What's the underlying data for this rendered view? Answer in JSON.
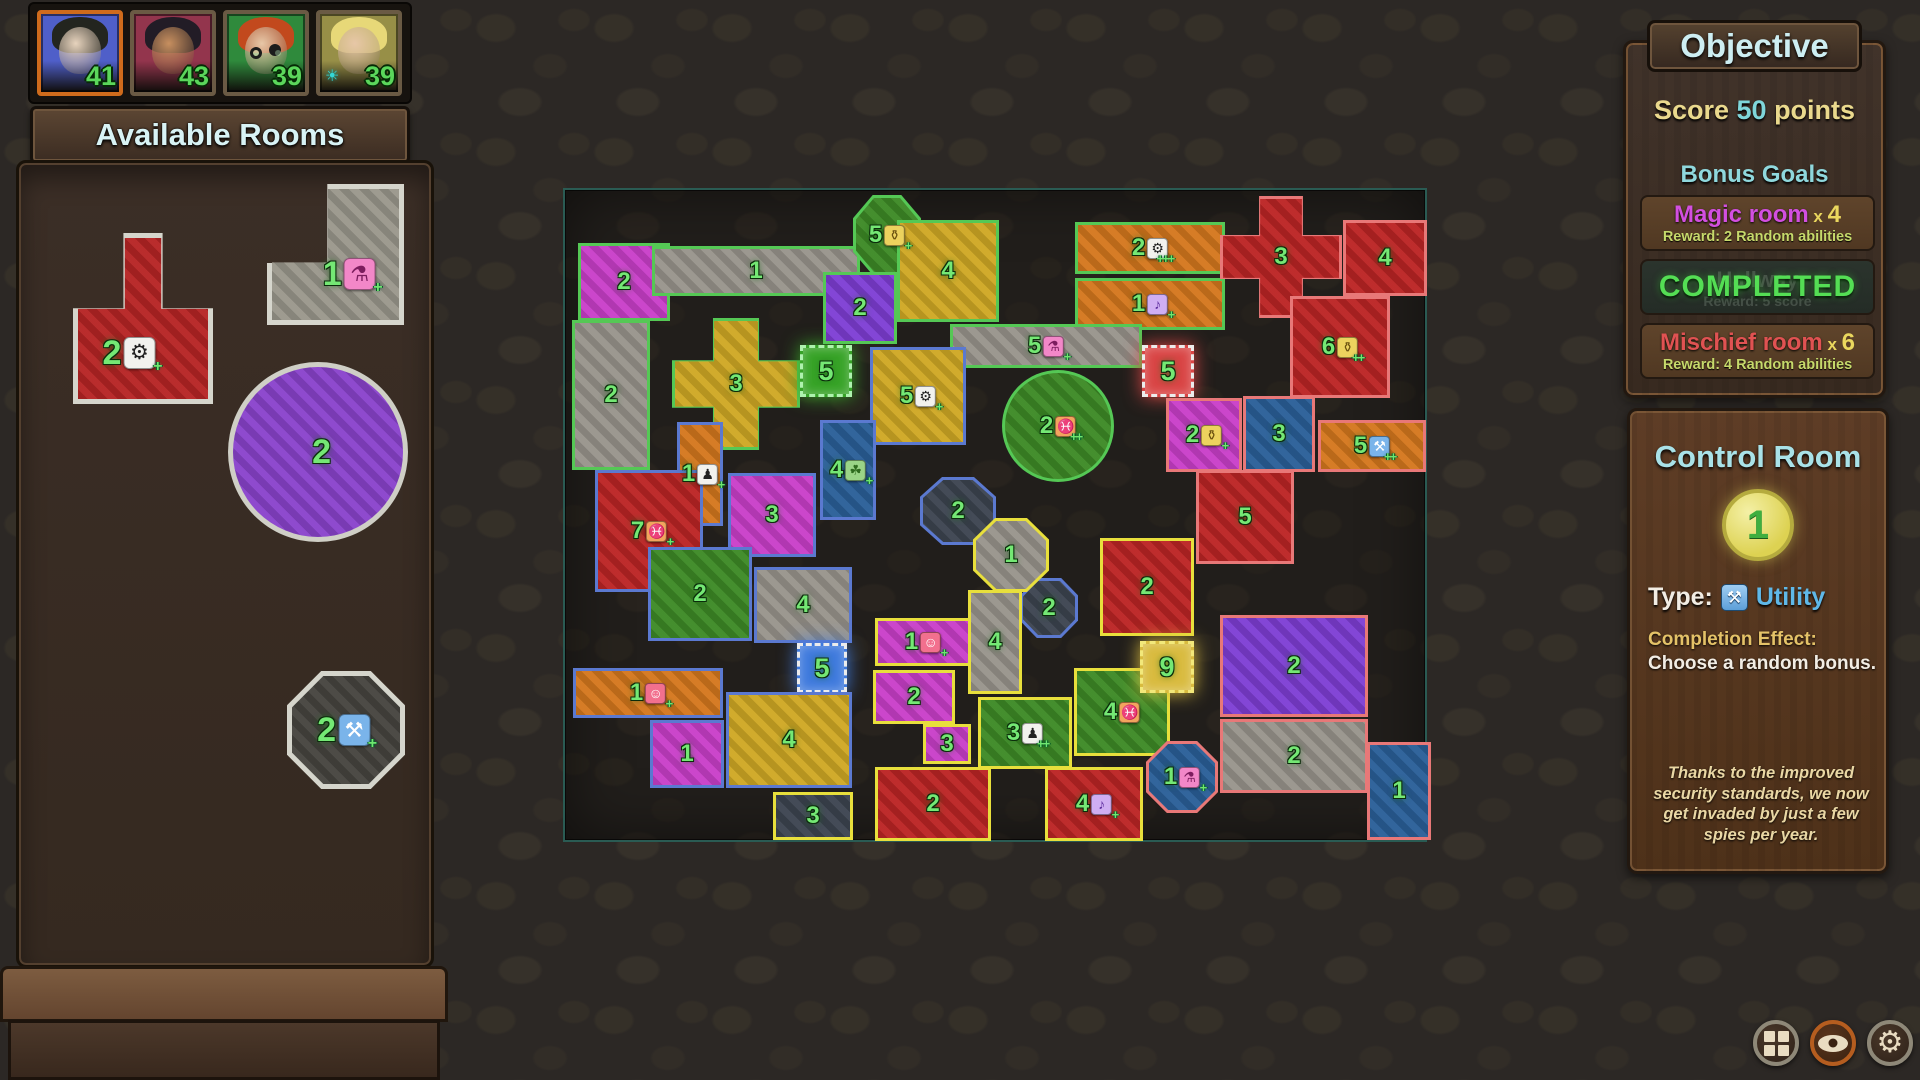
{
  "palette": {
    "fills": {
      "gray": "#98948c",
      "mag": "#c93fc9",
      "yel": "#cfa824",
      "org": "#d4771d",
      "red": "#bb2424",
      "pur": "#7e3ed4",
      "grn": "#3d8a26",
      "blu": "#2a5f98",
      "sla": "#3c4450",
      "gred": "#d94545",
      "gblu": "#3f7add",
      "ggld": "#d9bb3f",
      "ggrn": "#37a327"
    },
    "borders": {
      "g": "#55c855",
      "b": "#5b79d0",
      "y": "#e8df3c",
      "p": "#e87878",
      "w": "#ececec",
      "lg": "#d5d5cc",
      "ly": "#f2e87a",
      "lgn": "#aef2ae"
    },
    "accent_active_player": "#cf6b1c",
    "score_color": "#5bd65b",
    "map_frame": "#2a5b53"
  },
  "players": [
    {
      "score": "41",
      "bg": "#4f5fc9",
      "hair": "#23251f",
      "skin": "#e7d3bd",
      "active": true
    },
    {
      "score": "43",
      "bg": "#93354d",
      "hair": "#221c26",
      "skin": "#c78f5f"
    },
    {
      "score": "39",
      "bg": "#2f8a3c",
      "hair": "#c2491d",
      "skin": "#e7c7a7",
      "glasses": true
    },
    {
      "score": "39",
      "bg": "#978f47",
      "hair": "#e7d878",
      "skin": "#e7c7a7",
      "sun_badge": true
    }
  ],
  "left_panel": {
    "title": "Available Rooms",
    "tiles": [
      {
        "n": "2",
        "fill": "#b62424",
        "border": "#d5d5cc",
        "shape": "tee",
        "badge": {
          "i": "gear",
          "p": "+"
        },
        "x": 73,
        "y": 233,
        "w": 140,
        "h": 171,
        "cx": 40,
        "cy": 70
      },
      {
        "n": "1",
        "fill": "#9a978c",
        "border": "#d5d5cc",
        "shape": "ell",
        "badge": {
          "i": "potion",
          "p": "+"
        },
        "x": 267,
        "y": 184,
        "w": 137,
        "h": 141,
        "cx": 60,
        "cy": 64
      },
      {
        "n": "2",
        "fill": "#8a43cc",
        "border": "#cfcfc6",
        "shape": "circle",
        "x": 228,
        "y": 362,
        "w": 180,
        "h": 180,
        "cx": 52,
        "cy": 50
      },
      {
        "n": "2",
        "fill": "#46443f",
        "border": "#d5d5cc",
        "shape": "oct",
        "badge": {
          "i": "wrench",
          "p": "+"
        },
        "x": 287,
        "y": 671,
        "w": 118,
        "h": 118,
        "cx": 48,
        "cy": 50
      }
    ]
  },
  "map": {
    "frame": {
      "x": 563,
      "y": 188,
      "w": 864,
      "h": 654
    },
    "rooms": [
      {
        "n": "2",
        "x": 578,
        "y": 243,
        "w": 92,
        "h": 78,
        "f": "mag",
        "b": "g"
      },
      {
        "n": "1",
        "x": 652,
        "y": 246,
        "w": 208,
        "h": 50,
        "f": "gray",
        "b": "g"
      },
      {
        "n": "2",
        "x": 572,
        "y": 320,
        "w": 78,
        "h": 150,
        "f": "gray",
        "b": "g"
      },
      {
        "n": "3",
        "x": 672,
        "y": 318,
        "w": 128,
        "h": 132,
        "f": "yel",
        "b": "g",
        "s": "cross"
      },
      {
        "n": "5",
        "x": 800,
        "y": 345,
        "w": 52,
        "h": 52,
        "f": "ggrn",
        "b": "lgn",
        "g": true
      },
      {
        "n": "5",
        "x": 853,
        "y": 195,
        "w": 68,
        "h": 80,
        "f": "grn",
        "b": "g",
        "s": "oct",
        "bd": {
          "i": "bag",
          "p": "+"
        }
      },
      {
        "n": "2",
        "x": 823,
        "y": 272,
        "w": 74,
        "h": 72,
        "f": "pur",
        "b": "g"
      },
      {
        "n": "4",
        "x": 897,
        "y": 220,
        "w": 102,
        "h": 102,
        "f": "yel",
        "b": "g"
      },
      {
        "n": "2",
        "x": 1075,
        "y": 222,
        "w": 150,
        "h": 52,
        "f": "org",
        "b": "g",
        "bd": {
          "i": "gear",
          "p": "+++"
        }
      },
      {
        "n": "1",
        "x": 1075,
        "y": 278,
        "w": 150,
        "h": 52,
        "f": "org",
        "b": "g",
        "bd": {
          "i": "music",
          "p": "+"
        }
      },
      {
        "n": "5",
        "x": 950,
        "y": 324,
        "w": 192,
        "h": 44,
        "f": "gray",
        "b": "g",
        "bd": {
          "i": "potion",
          "p": "+"
        }
      },
      {
        "n": "2",
        "x": 1002,
        "y": 370,
        "w": 112,
        "h": 112,
        "f": "grn",
        "b": "g",
        "s": "circle",
        "bd": {
          "i": "fish",
          "p": "++"
        }
      },
      {
        "n": "5",
        "x": 870,
        "y": 347,
        "w": 96,
        "h": 98,
        "f": "yel",
        "b": "b",
        "bd": {
          "i": "gear",
          "p": "+"
        }
      },
      {
        "n": "4",
        "x": 820,
        "y": 420,
        "w": 56,
        "h": 100,
        "f": "blu",
        "b": "b",
        "bd": {
          "i": "leaf",
          "p": "+"
        }
      },
      {
        "n": "1",
        "x": 677,
        "y": 422,
        "w": 46,
        "h": 104,
        "f": "org",
        "b": "b",
        "bd": {
          "i": "person",
          "p": "+"
        }
      },
      {
        "n": "3",
        "x": 728,
        "y": 473,
        "w": 88,
        "h": 84,
        "f": "mag",
        "b": "b"
      },
      {
        "n": "7",
        "x": 595,
        "y": 470,
        "w": 108,
        "h": 122,
        "f": "red",
        "b": "b",
        "bd": {
          "i": "fish",
          "p": "+"
        }
      },
      {
        "n": "2",
        "x": 648,
        "y": 547,
        "w": 104,
        "h": 94,
        "f": "grn",
        "b": "b"
      },
      {
        "n": "4",
        "x": 754,
        "y": 567,
        "w": 98,
        "h": 76,
        "f": "gray",
        "b": "b"
      },
      {
        "n": "5",
        "x": 797,
        "y": 643,
        "w": 50,
        "h": 50,
        "f": "gblu",
        "b": "w",
        "g": true
      },
      {
        "n": "1",
        "x": 573,
        "y": 668,
        "w": 150,
        "h": 50,
        "f": "org",
        "b": "b",
        "bd": {
          "i": "smiley",
          "p": "+"
        }
      },
      {
        "n": "1",
        "x": 650,
        "y": 720,
        "w": 74,
        "h": 68,
        "f": "mag",
        "b": "b"
      },
      {
        "n": "4",
        "x": 726,
        "y": 692,
        "w": 126,
        "h": 96,
        "f": "yel",
        "b": "b"
      },
      {
        "n": "2",
        "x": 920,
        "y": 477,
        "w": 76,
        "h": 68,
        "f": "sla",
        "b": "b",
        "s": "oct"
      },
      {
        "n": "2",
        "x": 1020,
        "y": 578,
        "w": 58,
        "h": 60,
        "f": "sla",
        "b": "b",
        "s": "oct"
      },
      {
        "n": "3",
        "x": 773,
        "y": 792,
        "w": 80,
        "h": 48,
        "f": "sla",
        "b": "y"
      },
      {
        "n": "1",
        "x": 973,
        "y": 518,
        "w": 76,
        "h": 74,
        "f": "gray",
        "b": "y",
        "s": "oct"
      },
      {
        "n": "1",
        "x": 875,
        "y": 618,
        "w": 96,
        "h": 48,
        "f": "mag",
        "b": "y",
        "bd": {
          "i": "smiley",
          "p": "+"
        }
      },
      {
        "n": "4",
        "x": 968,
        "y": 590,
        "w": 54,
        "h": 104,
        "f": "gray",
        "b": "y"
      },
      {
        "n": "2",
        "x": 873,
        "y": 670,
        "w": 82,
        "h": 54,
        "f": "mag",
        "b": "y"
      },
      {
        "n": "3",
        "x": 923,
        "y": 724,
        "w": 48,
        "h": 40,
        "f": "mag",
        "b": "y"
      },
      {
        "n": "3",
        "x": 978,
        "y": 697,
        "w": 94,
        "h": 72,
        "f": "grn",
        "b": "y",
        "bd": {
          "i": "person",
          "p": "++"
        }
      },
      {
        "n": "4",
        "x": 1074,
        "y": 668,
        "w": 96,
        "h": 88,
        "f": "grn",
        "b": "y",
        "bd": {
          "i": "fish",
          "p": ""
        }
      },
      {
        "n": "2",
        "x": 875,
        "y": 767,
        "w": 116,
        "h": 74,
        "f": "red",
        "b": "y"
      },
      {
        "n": "4",
        "x": 1045,
        "y": 767,
        "w": 98,
        "h": 74,
        "f": "red",
        "b": "y",
        "bd": {
          "i": "music",
          "p": "+"
        }
      },
      {
        "n": "2",
        "x": 1100,
        "y": 538,
        "w": 94,
        "h": 98,
        "f": "red",
        "b": "y"
      },
      {
        "n": "9",
        "x": 1140,
        "y": 641,
        "w": 54,
        "h": 52,
        "f": "ggld",
        "b": "ly",
        "g": true
      },
      {
        "n": "3",
        "x": 1220,
        "y": 196,
        "w": 122,
        "h": 122,
        "f": "red",
        "b": "p",
        "s": "cross"
      },
      {
        "n": "4",
        "x": 1343,
        "y": 220,
        "w": 84,
        "h": 76,
        "f": "red",
        "b": "p"
      },
      {
        "n": "6",
        "x": 1290,
        "y": 296,
        "w": 100,
        "h": 102,
        "f": "red",
        "b": "p",
        "bd": {
          "i": "bag",
          "p": "++"
        }
      },
      {
        "n": "5",
        "x": 1142,
        "y": 345,
        "w": 52,
        "h": 52,
        "f": "gred",
        "b": "w",
        "g": true
      },
      {
        "n": "2",
        "x": 1166,
        "y": 398,
        "w": 76,
        "h": 74,
        "f": "mag",
        "b": "p",
        "bd": {
          "i": "bag",
          "p": "+"
        }
      },
      {
        "n": "3",
        "x": 1243,
        "y": 396,
        "w": 72,
        "h": 76,
        "f": "blu",
        "b": "p"
      },
      {
        "n": "5",
        "x": 1318,
        "y": 420,
        "w": 108,
        "h": 52,
        "f": "org",
        "b": "p",
        "bd": {
          "i": "wrench",
          "p": "++"
        }
      },
      {
        "n": "5",
        "x": 1196,
        "y": 470,
        "w": 98,
        "h": 94,
        "f": "red",
        "b": "p"
      },
      {
        "n": "2",
        "x": 1220,
        "y": 615,
        "w": 148,
        "h": 102,
        "f": "pur",
        "b": "p"
      },
      {
        "n": "2",
        "x": 1220,
        "y": 719,
        "w": 148,
        "h": 74,
        "f": "gray",
        "b": "p"
      },
      {
        "n": "1",
        "x": 1146,
        "y": 741,
        "w": 72,
        "h": 72,
        "f": "blu",
        "b": "p",
        "s": "oct",
        "bd": {
          "i": "potion",
          "p": "+"
        }
      },
      {
        "n": "1",
        "x": 1367,
        "y": 742,
        "w": 64,
        "h": 98,
        "f": "blu",
        "b": "p"
      }
    ]
  },
  "objective": {
    "title": "Objective",
    "score_prefix": "Score",
    "score_value": "50",
    "score_suffix": "points",
    "bonus_title": "Bonus Goals",
    "goals": [
      {
        "type": "goal",
        "name": "Magic room",
        "name_color": "#d24fe0",
        "mult": "4",
        "reward": "Reward: 2 Random abilities"
      },
      {
        "type": "completed",
        "completed_label": "COMPLETED",
        "behind_name": "Hallway",
        "behind_reward": "Reward: 5 score"
      },
      {
        "type": "goal",
        "name": "Mischief room",
        "name_color": "#e05252",
        "mult": "6",
        "reward": "Reward: 4 Random abilities"
      }
    ]
  },
  "control": {
    "title": "Control Room",
    "count": "1",
    "type_label": "Type:",
    "type_value": "Utility",
    "effect_label": "Completion Effect:",
    "effect_text": "Choose a random bonus.",
    "flavor": "Thanks to the improved security standards, we now get invaded by just a few spies per year."
  },
  "bottom_buttons": [
    {
      "icon": "grid"
    },
    {
      "icon": "eye",
      "active": true
    },
    {
      "icon": "gear"
    }
  ]
}
